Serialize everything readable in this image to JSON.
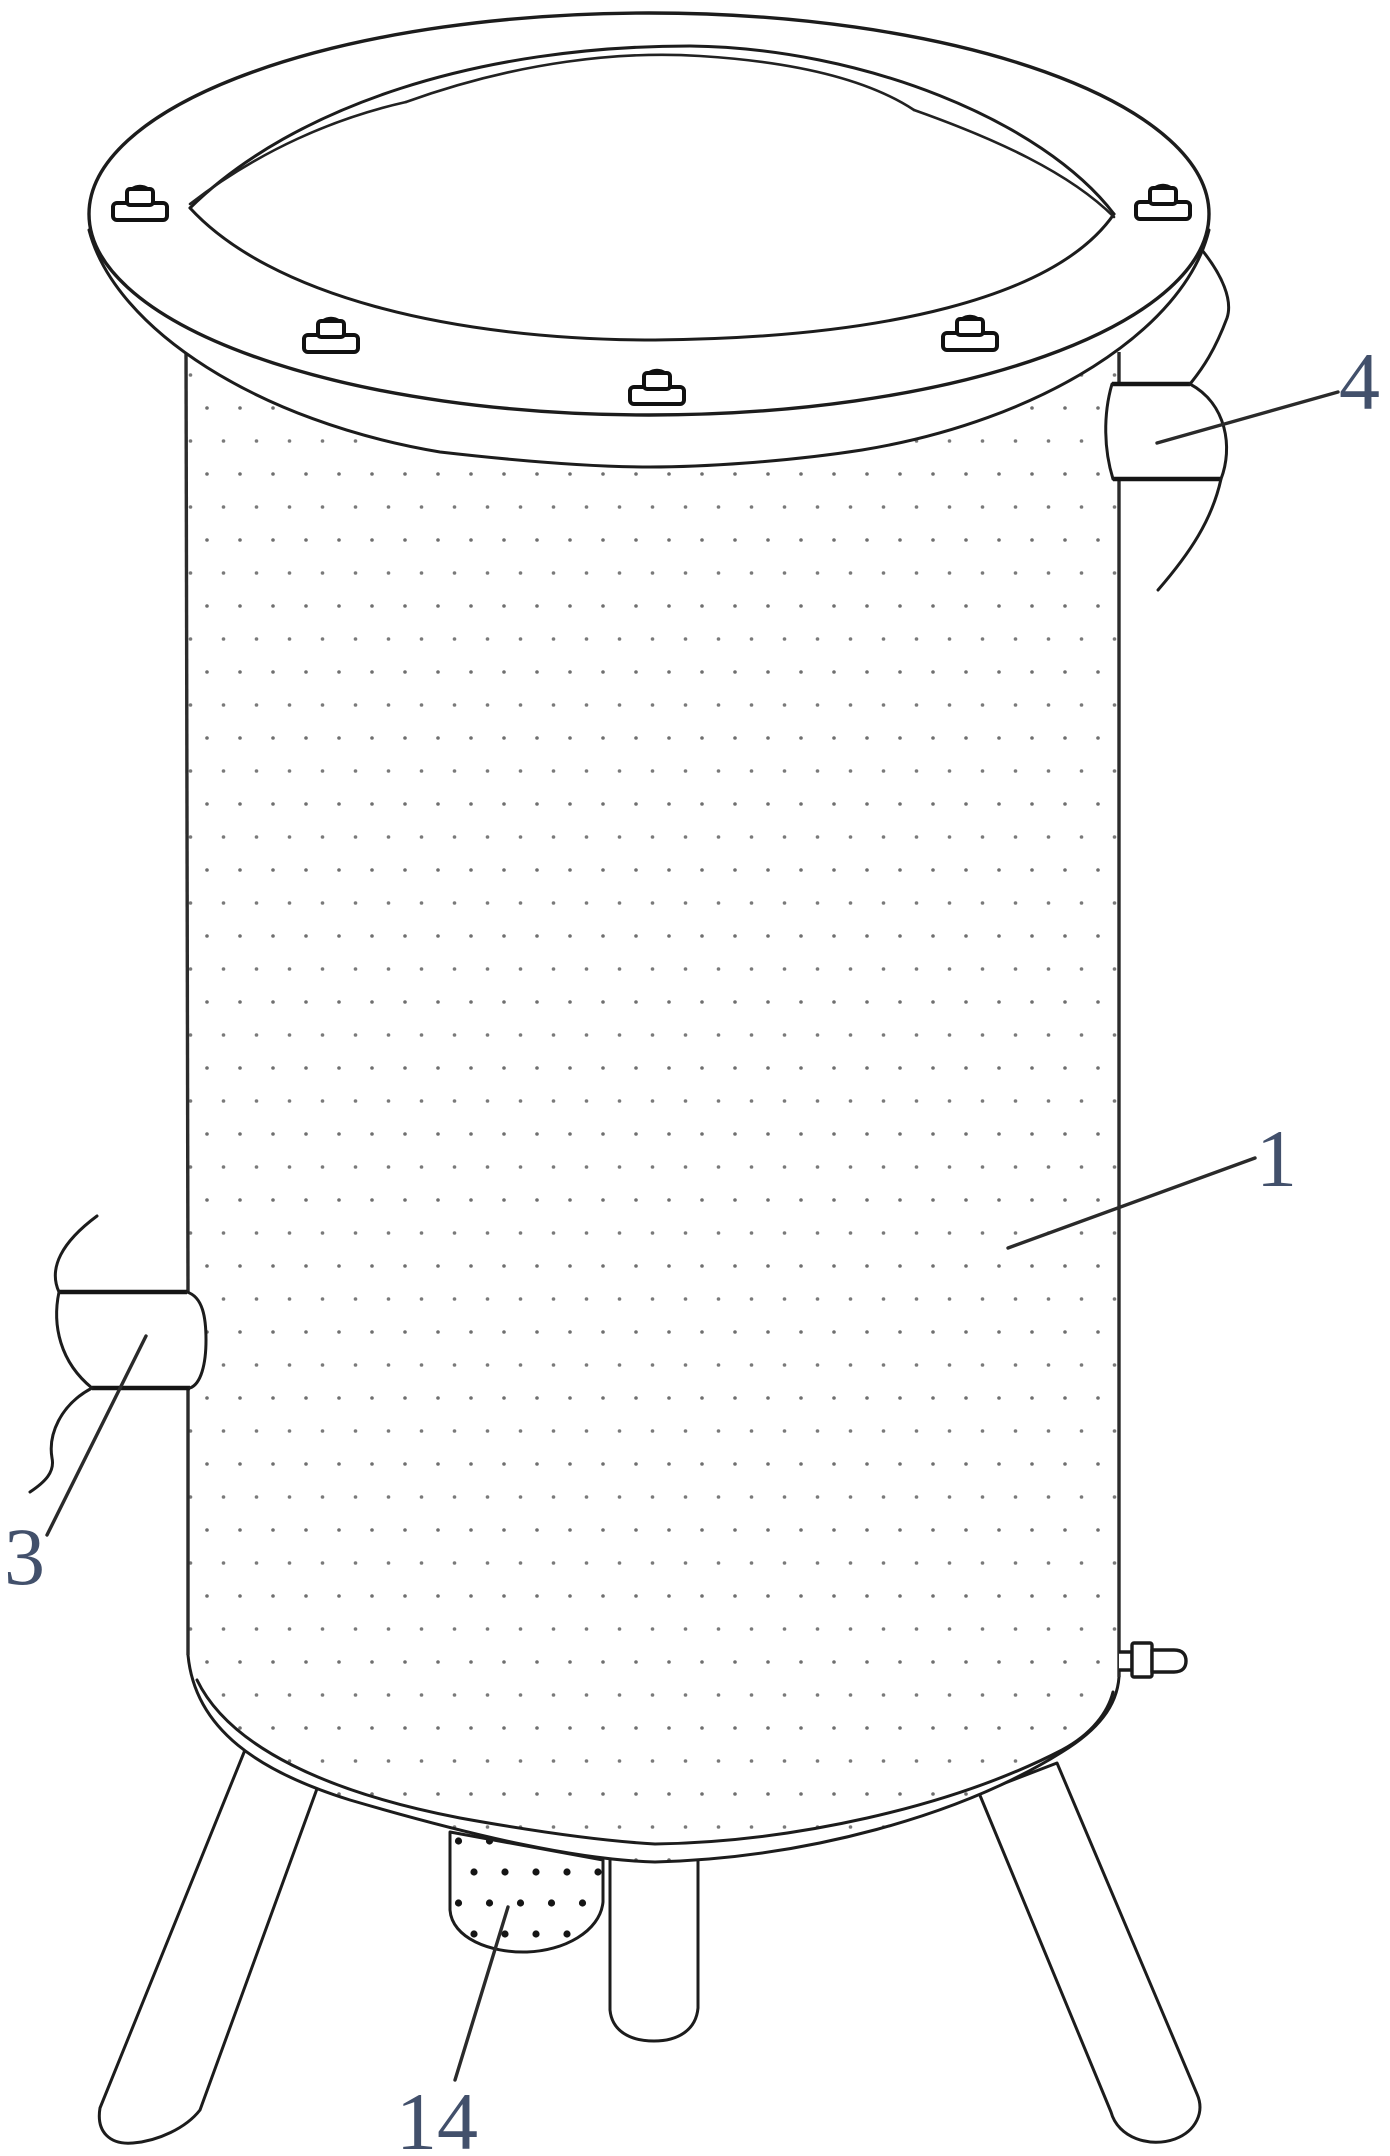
{
  "figure": {
    "kind": "patent-line-drawing",
    "background_color": "#ffffff",
    "line_color": "#1c1c1c",
    "label_color": "#42506b",
    "fine_stipple_color": "#6f6f6f",
    "coarse_stipple_color": "#151515"
  },
  "labels": [
    {
      "text": "1"
    },
    {
      "text": "3"
    },
    {
      "text": "4"
    },
    {
      "text": "14"
    }
  ]
}
